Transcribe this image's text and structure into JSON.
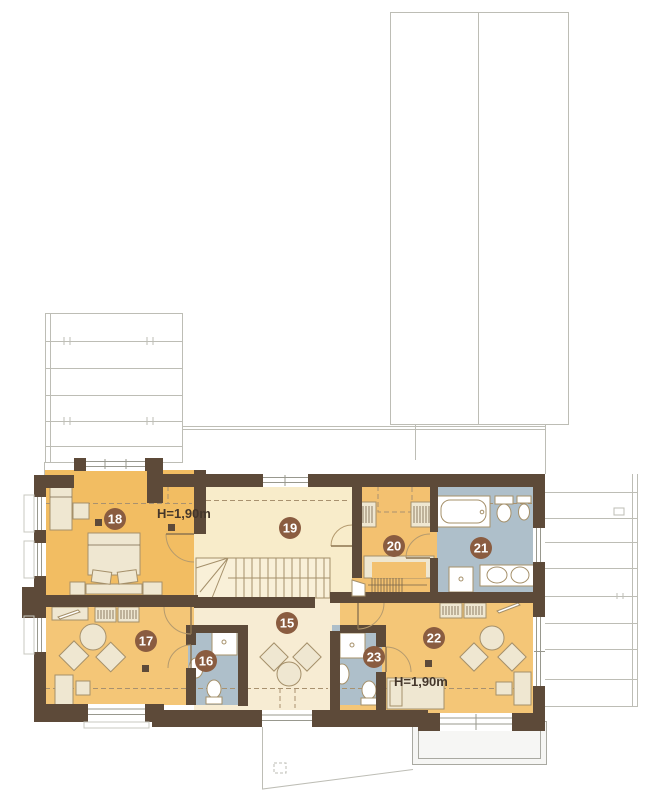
{
  "plan": {
    "kind": "attic-floor-plan",
    "rooms": [
      {
        "number": "15"
      },
      {
        "number": "16"
      },
      {
        "number": "17"
      },
      {
        "number": "18"
      },
      {
        "number": "19"
      },
      {
        "number": "20"
      },
      {
        "number": "21"
      },
      {
        "number": "22"
      },
      {
        "number": "23"
      }
    ],
    "annotations": {
      "height_label_top": "H=1,90m",
      "height_label_bottom": "H=1,90m"
    }
  },
  "palette": {
    "wall": "#5d4a39",
    "bedroom": "#f2bd62",
    "living": "#f4c677",
    "wardrobe": "#f3c170",
    "hall": "#f7ecd3",
    "landing": "#f8ecca",
    "bath": "#aebfca",
    "badge": "#8a5c40",
    "badge_text": "#ffffff",
    "furniture_fill": "#efe7d1",
    "furniture_stroke": "#a5906a",
    "fixture": "#ffffff",
    "dashed": "#a8916f",
    "faint": "#bdbdb5",
    "balcony_fill": "#f6f6f4",
    "balcony_stroke": "#a9a9a1",
    "label": "#44362a",
    "window_line": "#98988e",
    "stairs_fill": "#f9f0d8"
  }
}
